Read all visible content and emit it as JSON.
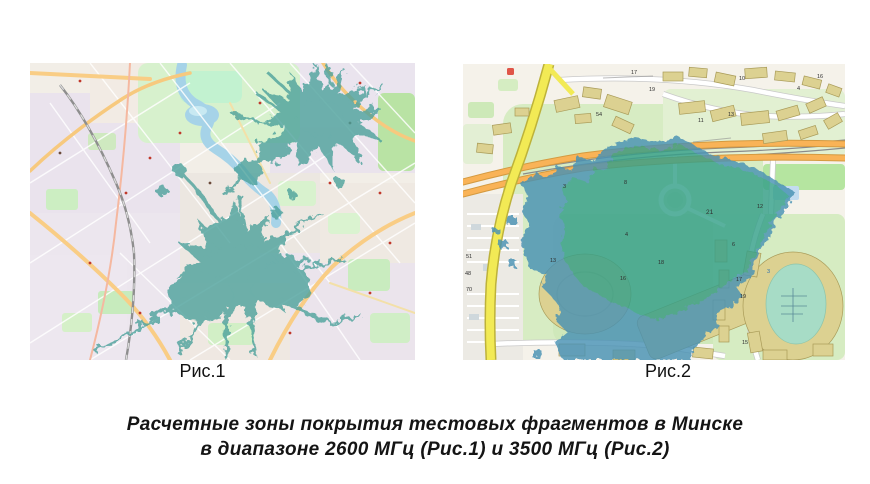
{
  "figure1": {
    "caption": "Рис.1"
  },
  "figure2": {
    "caption": "Рис.2"
  },
  "caption": {
    "line1": "Расчетные зоны покрытия тестовых фрагментов в Минске",
    "line2": "в диапазоне 2600 МГц (Рис.1) и 3500 МГц (Рис.2)"
  },
  "colors": {
    "coverage_fig1": "#4da29c",
    "coverage_fig2_green": "#35a089",
    "coverage_fig2_blue": "#4a92b4",
    "map_green": "#d7ecc3",
    "building_tan": "#dcd191",
    "road_orange": "#f9b357",
    "road_yellow": "#f2ea55",
    "water_blue": "#a6d3e8"
  },
  "map2": {
    "labels": [
      {
        "t": "54"
      },
      {
        "t": "17"
      },
      {
        "t": "19"
      },
      {
        "t": "10"
      },
      {
        "t": "4"
      },
      {
        "t": "16"
      },
      {
        "t": "11"
      },
      {
        "t": "13"
      },
      {
        "t": "3"
      },
      {
        "t": "8"
      },
      {
        "t": "21"
      },
      {
        "t": "6"
      },
      {
        "t": "4"
      },
      {
        "t": "51"
      },
      {
        "t": "48"
      },
      {
        "t": "70"
      },
      {
        "t": "13"
      },
      {
        "t": "18"
      },
      {
        "t": "16"
      },
      {
        "t": "12"
      },
      {
        "t": "17"
      },
      {
        "t": "19"
      },
      {
        "t": "15"
      },
      {
        "t": "3"
      }
    ]
  }
}
